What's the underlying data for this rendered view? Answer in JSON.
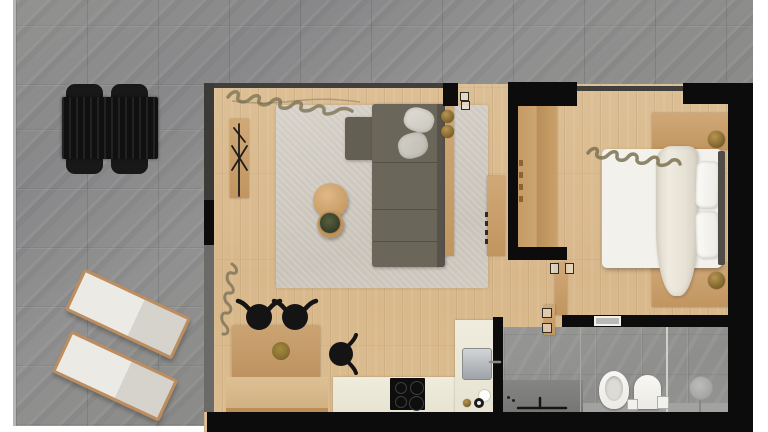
{
  "scene": {
    "title": "apartment-floor-plan-render",
    "view": "top-down 3D rendered floor plan, no text labels",
    "rooms": [
      {
        "name": "terrace",
        "floor": "large gray stone tiles (L-shaped around apartment, left and top)",
        "furniture": [
          "black outdoor dining table",
          "4 black outdoor chairs",
          "2 wood-framed sun loungers with white cushions (rotated ~25deg)"
        ]
      },
      {
        "name": "living-room",
        "floor": "light oak plank flooring",
        "furniture": [
          "beige area rug",
          "L-shaped taupe sectional sofa with 2 gray throw pillows",
          "round wooden coffee table (large + small nesting)",
          "potted plant on small table",
          "wooden sideboard with black branch decor",
          "narrow wooden console behind sofa with 2 brass lamps",
          "wooden media panel"
        ]
      },
      {
        "name": "kitchen-dining",
        "floor": "light oak plank flooring",
        "furniture": [
          "wooden dining table with lower platform",
          "3 black horned dining chairs",
          "brass charger plate",
          "cream kitchen counters (L-shaped)",
          "black induction cooktop with 4 burners",
          "stainless steel sink module",
          "counter accessories (white ring, brass knob, black knob)"
        ]
      },
      {
        "name": "bedroom",
        "floor": "light oak plank flooring",
        "furniture": [
          "double bed with white linens",
          "draped cream duvet",
          "2 white pillows",
          "dark headboard strip",
          "tall wooden wardrobe",
          "2 wooden nightstands",
          "2 round brass lamps",
          "open wooden door leaves"
        ]
      },
      {
        "name": "bathroom",
        "floor": "gray stone tile",
        "furniture": [
          "gray stone vanity with black wall faucet",
          "wall-hung toilet",
          "bidet",
          "flush plates",
          "walk-in shower with round rain head",
          "glass partition line",
          "white wall niche"
        ]
      }
    ],
    "decor": [
      "plant garland shadow along living-room top wall",
      "plant garland shadow along bedroom top wall",
      "vertical plant garland on living-room left wall",
      "black branch sculpture on sideboard"
    ],
    "walls": "thick black interior walls, thin dark glazing lines on window walls, white page margins left/right"
  },
  "palette": {
    "page_bg": "#ffffff",
    "wall_black": "#0c0c0c",
    "wall_gray": "#413f3b",
    "glass_gray": "#6b6a66",
    "stone_gray": "#8d8d8b",
    "wood_floor": "#d9ba8e",
    "wood_furniture": "#c79f6b",
    "sofa_taupe": "#6b665a",
    "sofa_dark": "#57524a",
    "rug_beige": "#cfc9bf",
    "cream_counter": "#ebe7d8",
    "cooktop_black": "#0e0e0e",
    "steel": "#b9bcbe",
    "brass": "#8f7339",
    "linen_white": "#f3f1ec",
    "duvet_cream": "#e9e4d9",
    "plant_green": "#3b422c",
    "bath_gray": "#929290",
    "vanity_gray": "#7c7c7a",
    "garland_olive": "#84795a"
  }
}
